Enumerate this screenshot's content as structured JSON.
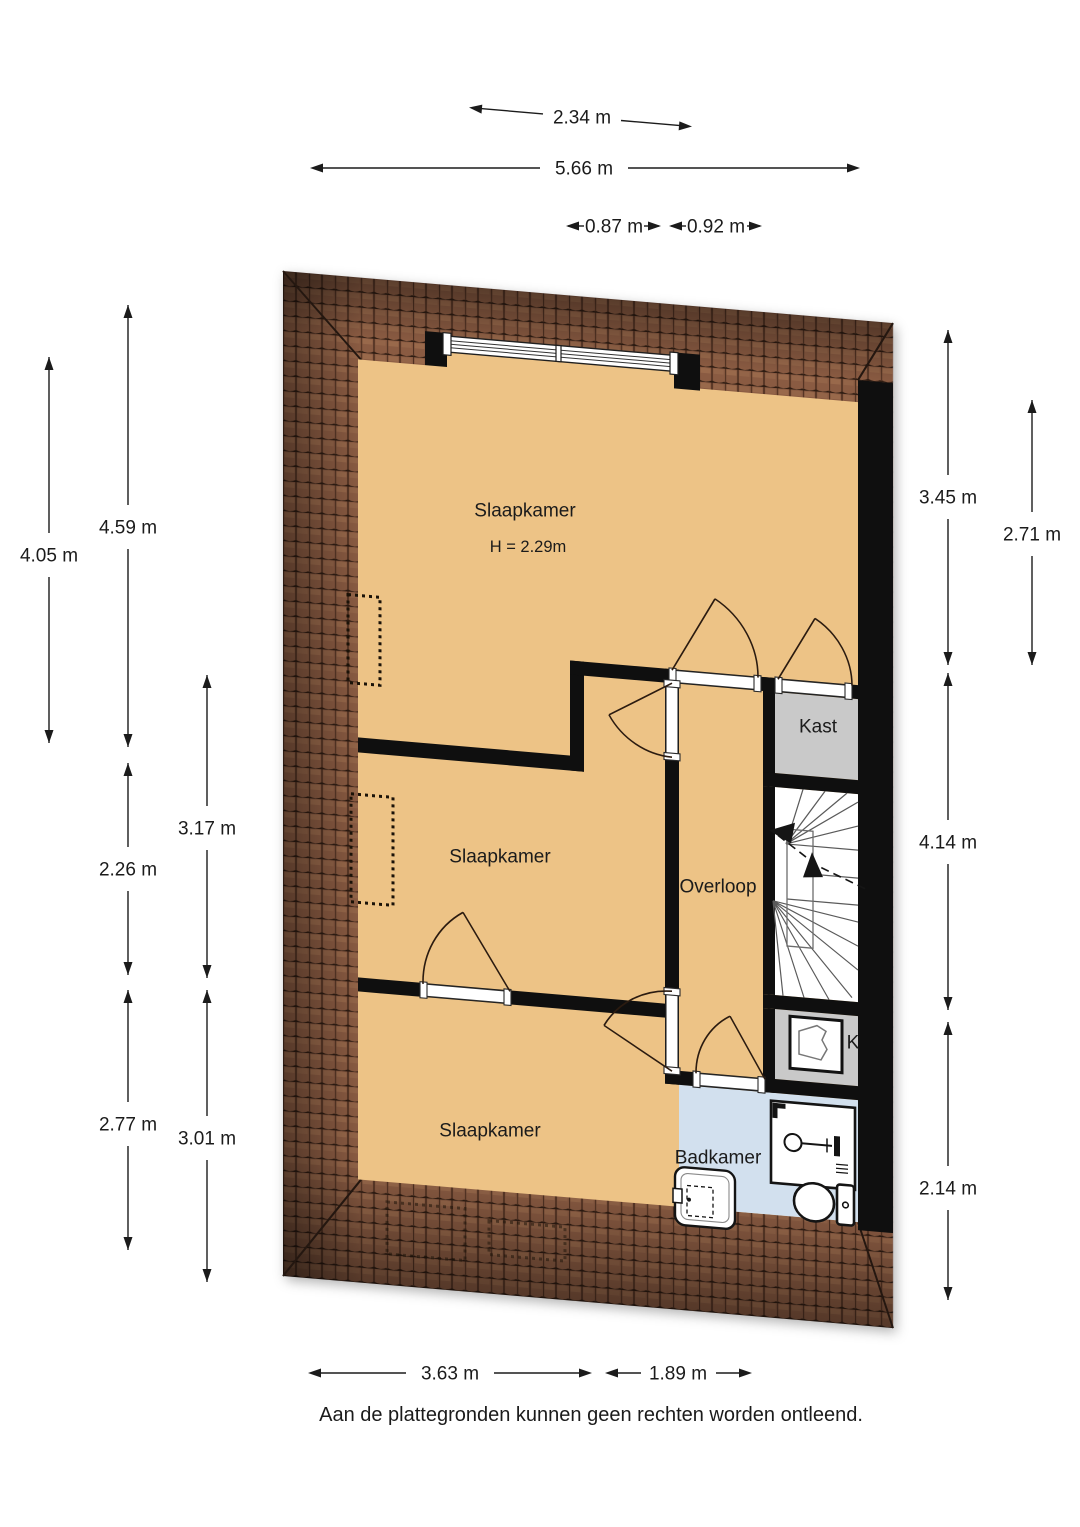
{
  "plan": {
    "footer": "Aan de plattegronden kunnen geen rechten worden ontleend.",
    "rooms": {
      "slaapkamer1": {
        "label": "Slaapkamer",
        "height": "H = 2.29m"
      },
      "slaapkamer2": {
        "label": "Slaapkamer"
      },
      "slaapkamer3": {
        "label": "Slaapkamer"
      },
      "overloop": {
        "label": "Overloop"
      },
      "kast": {
        "label": "Kast"
      },
      "badkamer": {
        "label": "Badkamer"
      },
      "ketelkast": {
        "label": "K"
      }
    },
    "dimensions": {
      "top": {
        "d234": "2.34 m",
        "d566": "5.66 m",
        "d087": "0.87 m",
        "d092": "0.92 m"
      },
      "left": {
        "d405": "4.05 m",
        "d459": "4.59 m",
        "d317": "3.17 m",
        "d226": "2.26 m",
        "d277": "2.77 m",
        "d301": "3.01 m"
      },
      "right": {
        "d345": "3.45 m",
        "d271": "2.71 m",
        "d414": "4.14 m",
        "d214": "2.14 m"
      },
      "bottom": {
        "d363": "3.63 m",
        "d189": "1.89 m"
      }
    },
    "colors": {
      "room": "#edc386",
      "bathroom": "#d2e0ee",
      "closet": "#c9c9c9",
      "stairs": "#ffffff",
      "roof": "#8a5b42",
      "wall": "#0f0f0f",
      "background": "#ffffff"
    }
  }
}
